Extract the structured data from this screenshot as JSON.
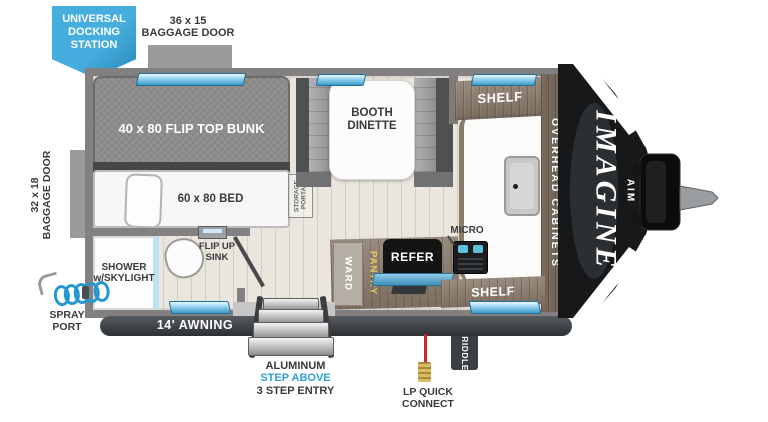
{
  "callouts": {
    "docking_station": {
      "l1": "UNIVERSAL",
      "l2": "DOCKING",
      "l3": "STATION"
    },
    "baggage_door_top": {
      "size": "36 x 15",
      "label": "BAGGAGE DOOR"
    },
    "baggage_door_left": {
      "size": "32 x 18",
      "label": "BAGGAGE DOOR"
    },
    "spray_port": {
      "l1": "SPRAY",
      "l2": "PORT"
    },
    "awning": "14' AWNING",
    "griddle": "GRIDDLE",
    "lp_quick_connect": {
      "l1": "LP QUICK",
      "l2": "CONNECT"
    },
    "entry_steps": {
      "l1": "ALUMINUM",
      "l2": "STEP ABOVE",
      "l3": "3 STEP ENTRY"
    }
  },
  "rooms": {
    "bunk": "40 x 80 FLIP TOP BUNK",
    "bed": "60 x 80 BED",
    "shower": {
      "l1": "SHOWER",
      "l2": "w/SKYLIGHT"
    },
    "flip_up_sink": {
      "l1": "FLIP UP",
      "l2": "SINK"
    },
    "dinette": {
      "l1": "BOOTH",
      "l2": "DINETTE"
    },
    "storage_portal": {
      "l1": "STORAGE",
      "l2": "PORTAL"
    },
    "shelf_top": "SHELF",
    "shelf_bottom": "SHELF",
    "overhead_cabinets": "OVERHEAD CABINETS",
    "micro": "MICRO",
    "refer": "REFER",
    "ward": "WARD",
    "pantry": "PANTRY"
  },
  "brand": {
    "model": "IMAGINE",
    "series": "AIM"
  },
  "colors": {
    "accent_blue": "#38a1d6",
    "window_blue": "#8fd0ee",
    "step_label_blue": "#2f9fd4",
    "pantry_yellow": "#e7c95c",
    "lp_red": "#c8252c",
    "cap_black": "#17181a",
    "wood": "#8d7e6f"
  }
}
